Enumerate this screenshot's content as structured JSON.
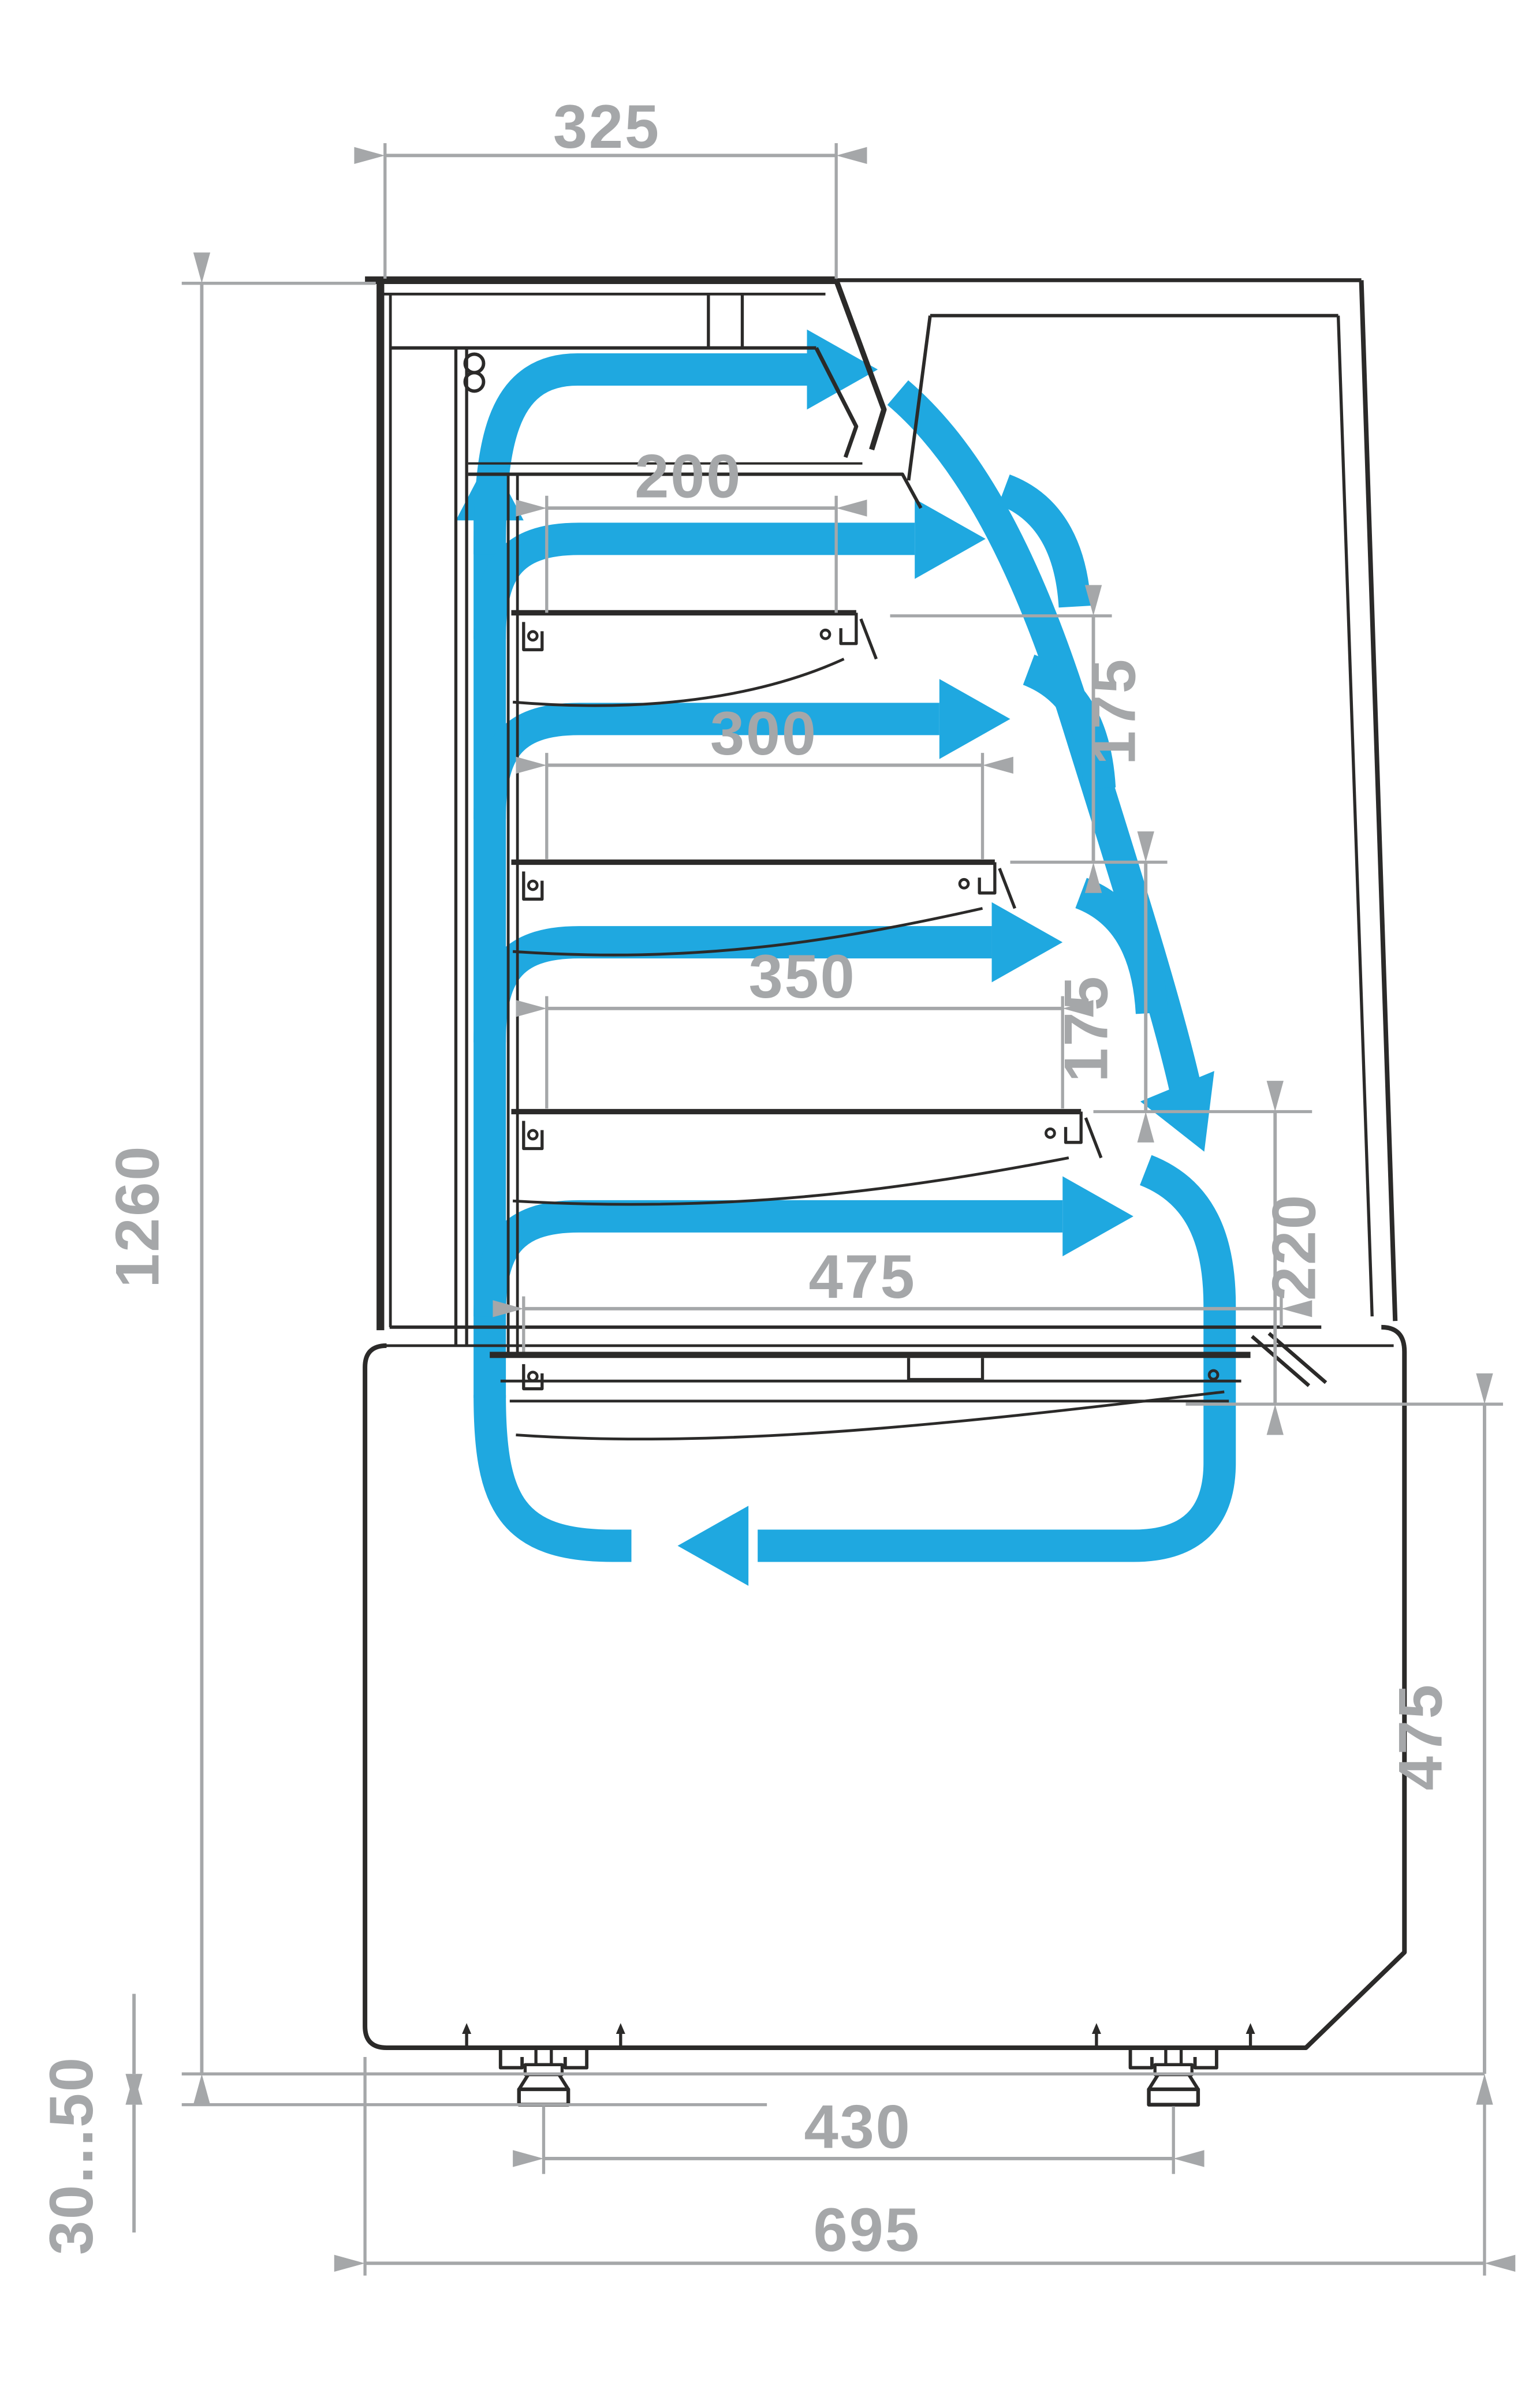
{
  "title": "Refrigerated pastry display case — side section with airflow and dimensions (mm)",
  "colors": {
    "airflow_blue": "#1FA8E0",
    "outline_black": "#2B2A29",
    "dimension_gray": "#A5A7A9",
    "background": "#FFFFFF"
  },
  "icons": {
    "fan": "fan-icon (double-circle symbol on back air duct)"
  },
  "dimensions": {
    "top_width": "325",
    "shelf1_depth": "200",
    "shelf2_depth": "300",
    "shelf3_depth": "350",
    "well_depth": "475",
    "shelf1_to_shelf2": "175",
    "shelf2_to_shelf3": "175",
    "shelf3_to_well": "220",
    "case_height": "1260",
    "foot_adjust_range": "30...50",
    "feet_spacing": "430",
    "base_depth": "695",
    "base_height": "475"
  }
}
